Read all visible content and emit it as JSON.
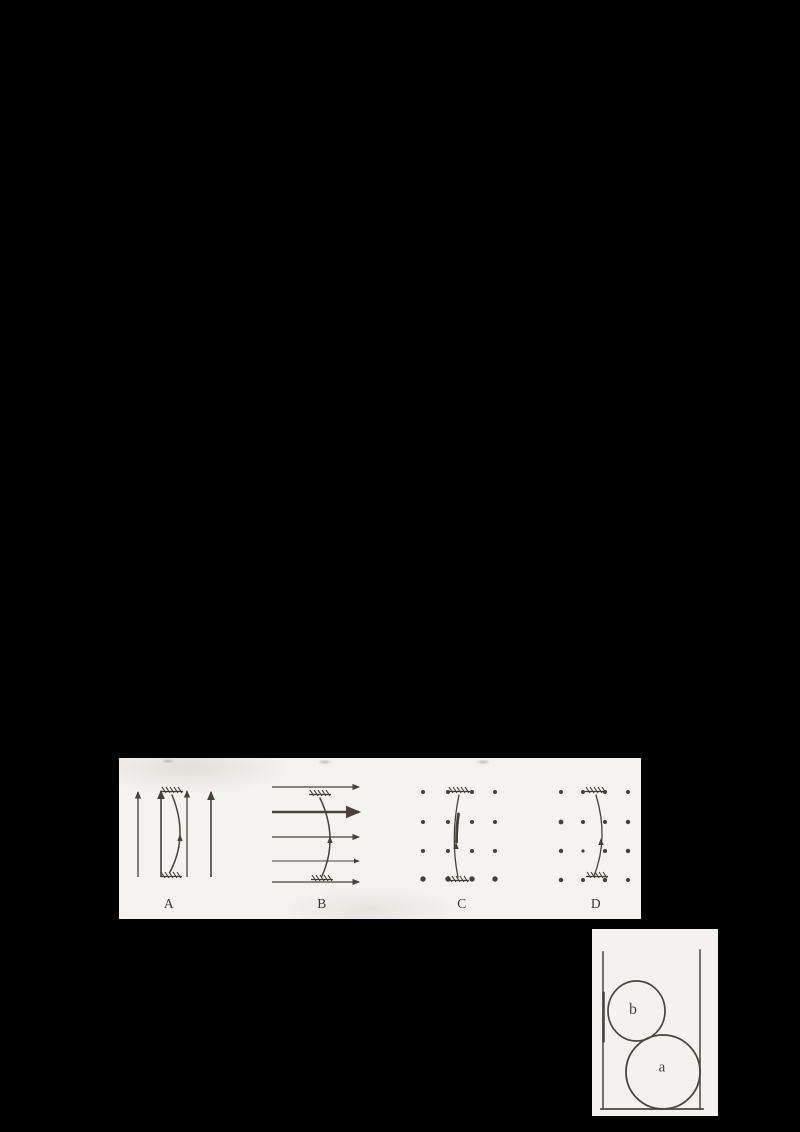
{
  "canvas": {
    "width": 800,
    "height": 1132,
    "background": "#000000"
  },
  "options_figure": {
    "background": "#f4f3ef",
    "ink_color": "#46423b",
    "panels": [
      {
        "label": "A",
        "field": "uniform-field-arrows-up",
        "wire": "anchored-wire-bowed-right"
      },
      {
        "label": "B",
        "field": "uniform-field-arrows-right",
        "wire": "anchored-wire-bowed-right"
      },
      {
        "label": "C",
        "field": "field-dots-out-of-page",
        "wire": "anchored-wire-bowed-left"
      },
      {
        "label": "D",
        "field": "field-dots-out-of-page",
        "wire": "anchored-wire-bowed-right"
      }
    ]
  },
  "container_figure": {
    "background": "#f3f2ee",
    "ink_color": "#4a463f",
    "balls": [
      {
        "label": "b",
        "size": "small",
        "position": "upper-left-against-wall"
      },
      {
        "label": "a",
        "size": "large",
        "position": "bottom-right-corner"
      }
    ]
  }
}
